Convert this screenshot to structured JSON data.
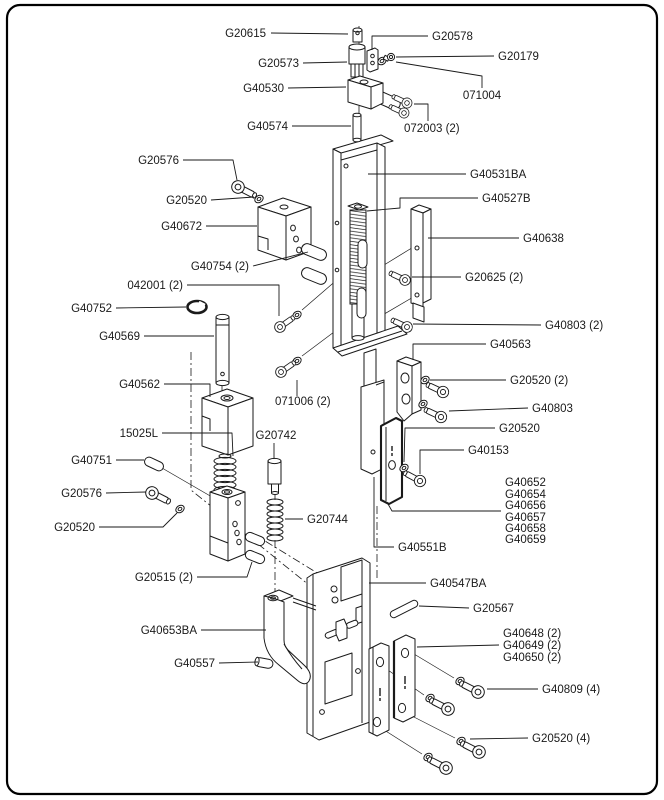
{
  "colors": {
    "ink": "#1a1a1a",
    "background": "#ffffff",
    "border": "#000000"
  },
  "diagram": {
    "type": "exploded-parts-diagram",
    "labels": [
      {
        "id": "G20615",
        "text": "G20615",
        "anchor": "end",
        "x": 266,
        "y": 37,
        "leader": [
          [
            271,
            33
          ],
          [
            348,
            34
          ]
        ]
      },
      {
        "id": "G20578",
        "text": "G20578",
        "anchor": "start",
        "x": 432,
        "y": 40,
        "leader": [
          [
            428,
            36
          ],
          [
            372,
            36
          ],
          [
            372,
            50
          ]
        ]
      },
      {
        "id": "G20179",
        "text": "G20179",
        "anchor": "start",
        "x": 498,
        "y": 60,
        "leader": [
          [
            494,
            56
          ],
          [
            396,
            57
          ]
        ]
      },
      {
        "id": "G20573",
        "text": "G20573",
        "anchor": "end",
        "x": 299,
        "y": 67,
        "leader": [
          [
            303,
            63
          ],
          [
            347,
            62
          ]
        ]
      },
      {
        "id": "G40530",
        "text": "G40530",
        "anchor": "end",
        "x": 284,
        "y": 92,
        "leader": [
          [
            288,
            88
          ],
          [
            346,
            87
          ]
        ]
      },
      {
        "id": "071004",
        "text": "071004",
        "anchor": "middle",
        "x": 482,
        "y": 99,
        "leader": [
          [
            396,
            62
          ],
          [
            482,
            76
          ],
          [
            482,
            88
          ]
        ]
      },
      {
        "id": "G40574",
        "text": "G40574",
        "anchor": "end",
        "x": 288,
        "y": 130,
        "leader": [
          [
            292,
            126
          ],
          [
            351,
            126
          ]
        ]
      },
      {
        "id": "072003",
        "text": "072003 (2)",
        "anchor": "start",
        "x": 404,
        "y": 132,
        "leader": [
          [
            414,
            104
          ],
          [
            428,
            104
          ],
          [
            428,
            121
          ]
        ]
      },
      {
        "id": "G20576-a",
        "text": "G20576",
        "anchor": "end",
        "x": 179,
        "y": 164,
        "leader": [
          [
            183,
            160
          ],
          [
            233,
            160
          ],
          [
            237,
            180
          ]
        ]
      },
      {
        "id": "G20520-a",
        "text": "G20520",
        "anchor": "end",
        "x": 207,
        "y": 204,
        "leader": [
          [
            211,
            200
          ],
          [
            254,
            197
          ]
        ]
      },
      {
        "id": "G40672",
        "text": "G40672",
        "anchor": "end",
        "x": 202,
        "y": 230,
        "leader": [
          [
            206,
            226
          ],
          [
            257,
            226
          ]
        ]
      },
      {
        "id": "G40754",
        "text": "G40754 (2)",
        "anchor": "end",
        "x": 249,
        "y": 270,
        "leader": [
          [
            253,
            266
          ],
          [
            308,
            252
          ]
        ]
      },
      {
        "id": "042001",
        "text": "042001 (2)",
        "anchor": "end",
        "x": 183,
        "y": 289,
        "leader": [
          [
            187,
            285
          ],
          [
            279,
            285
          ],
          [
            279,
            316
          ]
        ]
      },
      {
        "id": "G40752",
        "text": "G40752",
        "anchor": "end",
        "x": 112,
        "y": 312,
        "leader": [
          [
            116,
            308
          ],
          [
            186,
            307
          ]
        ]
      },
      {
        "id": "G40569",
        "text": "G40569",
        "anchor": "end",
        "x": 140,
        "y": 340,
        "leader": [
          [
            144,
            336
          ],
          [
            214,
            336
          ]
        ]
      },
      {
        "id": "G40531BA",
        "text": "G40531BA",
        "anchor": "start",
        "x": 470,
        "y": 178,
        "leader": [
          [
            466,
            174
          ],
          [
            368,
            174
          ]
        ]
      },
      {
        "id": "G40527B",
        "text": "G40527B",
        "anchor": "start",
        "x": 482,
        "y": 202,
        "leader": [
          [
            478,
            198
          ],
          [
            400,
            198
          ],
          [
            400,
            208
          ],
          [
            367,
            211
          ]
        ]
      },
      {
        "id": "G40638",
        "text": "G40638",
        "anchor": "start",
        "x": 523,
        "y": 242,
        "leader": [
          [
            519,
            238
          ],
          [
            428,
            238
          ]
        ]
      },
      {
        "id": "G20625",
        "text": "G20625 (2)",
        "anchor": "start",
        "x": 465,
        "y": 281,
        "leader": [
          [
            461,
            277
          ],
          [
            412,
            277
          ]
        ]
      },
      {
        "id": "G40803-2",
        "text": "G40803 (2)",
        "anchor": "start",
        "x": 545,
        "y": 329,
        "leader": [
          [
            541,
            325
          ],
          [
            413,
            324
          ]
        ]
      },
      {
        "id": "G40563",
        "text": "G40563",
        "anchor": "start",
        "x": 490,
        "y": 348,
        "leader": [
          [
            486,
            344
          ],
          [
            413,
            344
          ],
          [
            413,
            360
          ]
        ]
      },
      {
        "id": "G20520-2",
        "text": "G20520 (2)",
        "anchor": "start",
        "x": 510,
        "y": 384,
        "leader": [
          [
            506,
            380
          ],
          [
            430,
            380
          ]
        ]
      },
      {
        "id": "G40803",
        "text": "G40803",
        "anchor": "start",
        "x": 532,
        "y": 412,
        "leader": [
          [
            528,
            408
          ],
          [
            449,
            411
          ]
        ]
      },
      {
        "id": "G20520-b",
        "text": "G20520",
        "anchor": "start",
        "x": 499,
        "y": 432,
        "leader": [
          [
            495,
            428
          ],
          [
            405,
            428
          ],
          [
            404,
            462
          ]
        ]
      },
      {
        "id": "G40153",
        "text": "G40153",
        "anchor": "start",
        "x": 468,
        "y": 454,
        "leader": [
          [
            464,
            450
          ],
          [
            420,
            450
          ],
          [
            420,
            474
          ]
        ]
      },
      {
        "id": "G40652",
        "text": "G40652",
        "anchor": "start",
        "x": 505,
        "y": 486,
        "leader": null
      },
      {
        "id": "G40654",
        "text": "G40654",
        "anchor": "start",
        "x": 505,
        "y": 498,
        "leader": null
      },
      {
        "id": "G40656",
        "text": "G40656",
        "anchor": "start",
        "x": 505,
        "y": 509,
        "leader": [
          [
            501,
            511
          ],
          [
            392,
            511
          ],
          [
            388,
            504
          ]
        ]
      },
      {
        "id": "G40657",
        "text": "G40657",
        "anchor": "start",
        "x": 505,
        "y": 521,
        "leader": null
      },
      {
        "id": "G40658",
        "text": "G40658",
        "anchor": "start",
        "x": 505,
        "y": 532,
        "leader": null
      },
      {
        "id": "G40659",
        "text": "G40659",
        "anchor": "start",
        "x": 505,
        "y": 543,
        "leader": null
      },
      {
        "id": "G40551B",
        "text": "G40551B",
        "anchor": "start",
        "x": 398,
        "y": 551,
        "leader": [
          [
            394,
            547
          ],
          [
            374,
            547
          ],
          [
            374,
            477
          ]
        ]
      },
      {
        "id": "G40547BA",
        "text": "G40547BA",
        "anchor": "start",
        "x": 430,
        "y": 587,
        "leader": [
          [
            426,
            583
          ],
          [
            369,
            583
          ]
        ]
      },
      {
        "id": "G20567",
        "text": "G20567",
        "anchor": "start",
        "x": 473,
        "y": 612,
        "leader": [
          [
            469,
            608
          ],
          [
            419,
            606
          ]
        ]
      },
      {
        "id": "G40648",
        "text": "G40648 (2)",
        "anchor": "start",
        "x": 503,
        "y": 637,
        "leader": null
      },
      {
        "id": "G40649",
        "text": "G40649 (2)",
        "anchor": "start",
        "x": 503,
        "y": 649,
        "leader": [
          [
            499,
            645
          ],
          [
            417,
            647
          ]
        ]
      },
      {
        "id": "G40650",
        "text": "G40650 (2)",
        "anchor": "start",
        "x": 503,
        "y": 661,
        "leader": null
      },
      {
        "id": "G40809",
        "text": "G40809 (4)",
        "anchor": "start",
        "x": 542,
        "y": 693,
        "leader": [
          [
            538,
            689
          ],
          [
            487,
            689
          ]
        ]
      },
      {
        "id": "G20520-4",
        "text": "G20520 (4)",
        "anchor": "start",
        "x": 532,
        "y": 742,
        "leader": [
          [
            528,
            738
          ],
          [
            470,
            739
          ]
        ]
      },
      {
        "id": "G20515",
        "text": "G20515 (2)",
        "anchor": "end",
        "x": 193,
        "y": 581,
        "leader": [
          [
            197,
            577
          ],
          [
            247,
            577
          ],
          [
            252,
            562
          ]
        ]
      },
      {
        "id": "G40653BA",
        "text": "G40653BA",
        "anchor": "end",
        "x": 197,
        "y": 634,
        "leader": [
          [
            201,
            630
          ],
          [
            266,
            630
          ]
        ]
      },
      {
        "id": "G40557",
        "text": "G40557",
        "anchor": "end",
        "x": 215,
        "y": 667,
        "leader": [
          [
            219,
            663
          ],
          [
            258,
            662
          ]
        ]
      },
      {
        "id": "15025L",
        "text": "15025L",
        "anchor": "end",
        "x": 158,
        "y": 437,
        "leader": [
          [
            162,
            433
          ],
          [
            232,
            433
          ],
          [
            233,
            456
          ]
        ]
      },
      {
        "id": "G40751",
        "text": "G40751",
        "anchor": "end",
        "x": 112,
        "y": 464,
        "leader": [
          [
            116,
            460
          ],
          [
            144,
            460
          ]
        ]
      },
      {
        "id": "G20576-b",
        "text": "G20576",
        "anchor": "end",
        "x": 102,
        "y": 497,
        "leader": [
          [
            106,
            493
          ],
          [
            146,
            492
          ]
        ]
      },
      {
        "id": "G20520-c",
        "text": "G20520",
        "anchor": "end",
        "x": 95,
        "y": 531,
        "leader": [
          [
            99,
            527
          ],
          [
            163,
            527
          ],
          [
            177,
            513
          ]
        ]
      },
      {
        "id": "G20742",
        "text": "G20742",
        "anchor": "middle",
        "x": 276,
        "y": 439,
        "leader": [
          [
            274,
            443
          ],
          [
            274,
            459
          ]
        ]
      },
      {
        "id": "G20744",
        "text": "G20744",
        "anchor": "start",
        "x": 307,
        "y": 523,
        "leader": [
          [
            303,
            519
          ],
          [
            285,
            519
          ]
        ]
      },
      {
        "id": "071006",
        "text": "071006 (2)",
        "anchor": "start",
        "x": 275,
        "y": 405,
        "leader": [
          [
            297,
            396
          ],
          [
            297,
            380
          ]
        ]
      },
      {
        "id": "G40562",
        "text": "G40562",
        "anchor": "end",
        "x": 160,
        "y": 388,
        "leader": [
          [
            164,
            384
          ],
          [
            210,
            384
          ],
          [
            210,
            397
          ]
        ]
      }
    ]
  }
}
